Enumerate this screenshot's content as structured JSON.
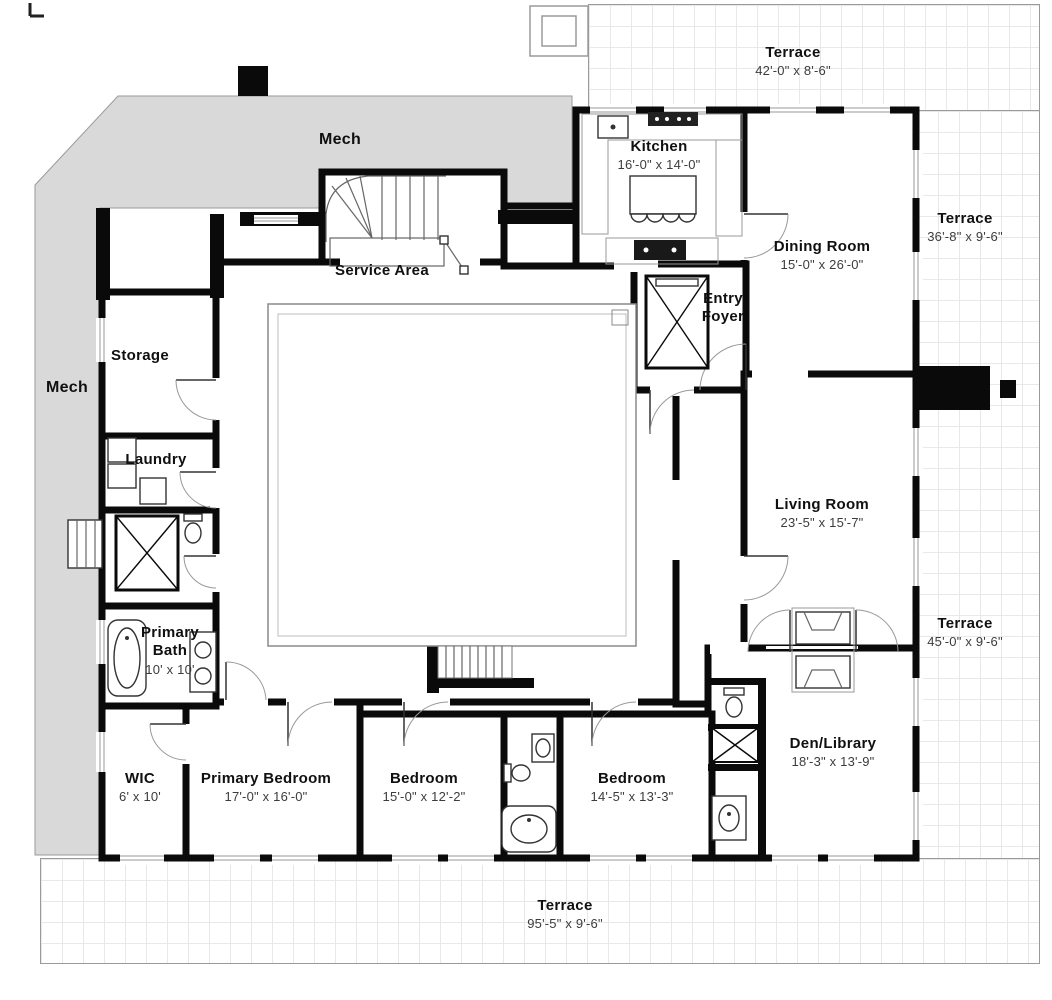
{
  "colors": {
    "wall": "#0a0a0a",
    "mech_fill": "#d9d9d9",
    "terrace_grid_line": "#e8e8e8",
    "terrace_border": "#9a9a9a",
    "room_name_text": "#101010",
    "dims_text": "#3c3c3c"
  },
  "plan": {
    "mech_top_label": "Mech",
    "mech_left_label": "Mech",
    "rooms": {
      "kitchen": {
        "name": "Kitchen",
        "dims": "16'-0\" x 14'-0\""
      },
      "dining_room": {
        "name": "Dining Room",
        "dims": "15'-0\" x 26'-0\""
      },
      "entry_foyer": {
        "name": "Entry Foyer"
      },
      "service_area": {
        "name": "Service Area"
      },
      "storage": {
        "name": "Storage"
      },
      "laundry": {
        "name": "Laundry"
      },
      "living_room": {
        "name": "Living Room",
        "dims": "23'-5\" x 15'-7\""
      },
      "primary_bath": {
        "name": "Primary Bath",
        "dims": "10' x 10'"
      },
      "wic": {
        "name": "WIC",
        "dims": "6' x 10'"
      },
      "primary_bedroom": {
        "name": "Primary Bedroom",
        "dims": "17'-0\" x 16'-0\""
      },
      "bedroom_2": {
        "name": "Bedroom",
        "dims": "15'-0\" x 12'-2\""
      },
      "bedroom_3": {
        "name": "Bedroom",
        "dims": "14'-5\" x 13'-3\""
      },
      "den_library": {
        "name": "Den/Library",
        "dims": "18'-3\" x 13'-9\""
      }
    },
    "terraces": {
      "top": {
        "name": "Terrace",
        "dims": "42'-0\" x 8'-6\""
      },
      "right_upper": {
        "name": "Terrace",
        "dims": "36'-8\" x 9'-6\""
      },
      "right_lower": {
        "name": "Terrace",
        "dims": "45'-0\" x 9'-6\""
      },
      "bottom": {
        "name": "Terrace",
        "dims": "95'-5\" x 9'-6\""
      }
    }
  }
}
